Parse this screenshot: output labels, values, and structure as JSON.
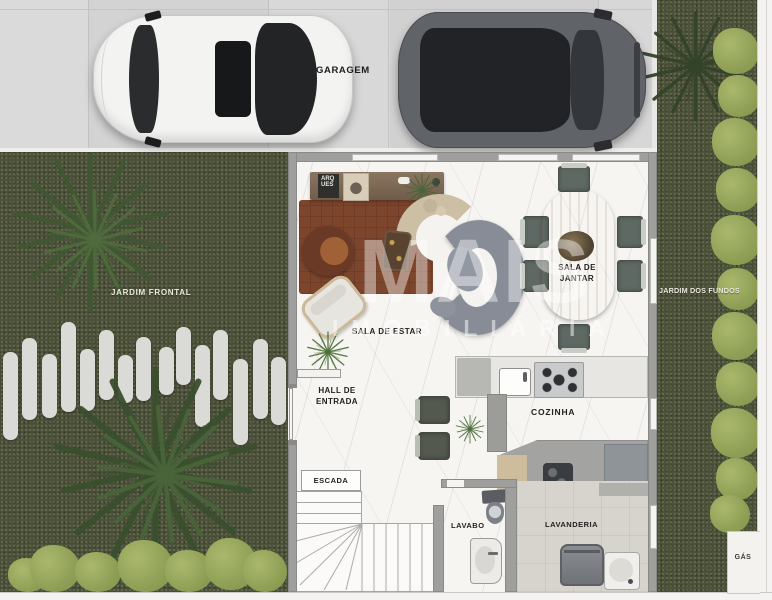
{
  "garage": {
    "label": "GARAGEM"
  },
  "gardens": {
    "front_label": "JARDIM FRONTAL",
    "back_label": "JARDIM DOS FUNDOS",
    "gas_label": "GÁS"
  },
  "rooms": {
    "living": "SALA DE ESTAR",
    "dining": "SALA DE JANTAR",
    "hall": "HALL DE ENTRADA",
    "kitchen": "COZINHA",
    "stairs": "ESCADA",
    "toilet": "LAVABO",
    "laundry": "LAVANDERIA"
  },
  "decor": {
    "poster_text": "ARQ UES"
  },
  "watermark": {
    "line1": "MAIS",
    "line2": "IMOBILIÁRIA"
  },
  "colors": {
    "grass": "#4c5139",
    "shrub": "#9aab60",
    "paving": "#d6d6d6",
    "marble_floor": "#f6f5f2",
    "wall": "#9f9f9d",
    "wood_table": "#c8a571",
    "rug": "#7c452c",
    "sofa": "#868b94",
    "car_white": "#f3f3f2",
    "car_suv": "#606468",
    "laundry_floor": "#d7d4ce"
  }
}
